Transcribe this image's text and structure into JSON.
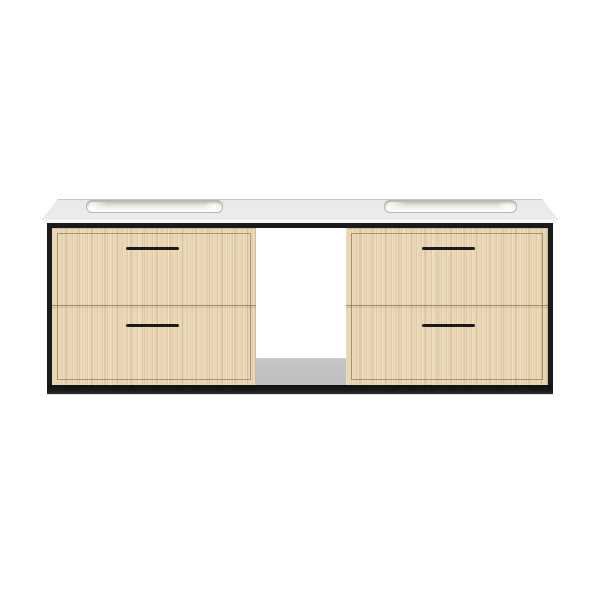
{
  "product": {
    "title": "Wall-mounted double bathroom vanity with black metal frame, light oak drawers and white countertop",
    "scene": "product photo on plain white background",
    "countertop": {
      "part": "white solid-surface slab countertop",
      "sink_count": 2,
      "sinks": [
        "integrated rectangular basin left",
        "integrated rectangular basin right"
      ]
    },
    "frame": {
      "part": "matte black metal frame",
      "rails": [
        "top rail",
        "left rail",
        "right rail",
        "bottom rail"
      ]
    },
    "drawer_banks": {
      "count": 2,
      "drawers_per_bank": 2,
      "total_drawers": 4,
      "finish": "light oak vertical grain",
      "pull_style": "slim black horizontal bar",
      "pull_count": 4
    },
    "open_shelf": {
      "part": "open center compartment",
      "floor": "gray interior bottom"
    }
  },
  "colors": {
    "background": "#ffffff",
    "counter_top": "#e8e8e8",
    "counter_edge": "#c6c6c6",
    "counter_face": "#f9f9f9",
    "sink_rim": "#b7b7ad",
    "sink_basin": "#dcddd2",
    "sink_basin_light": "#f4f5ec",
    "frame_black": "#1a1a1a",
    "wood_base": "#e9d6b4",
    "wood_border": "#7a613a",
    "floor_gray": "#c2c2c2"
  }
}
